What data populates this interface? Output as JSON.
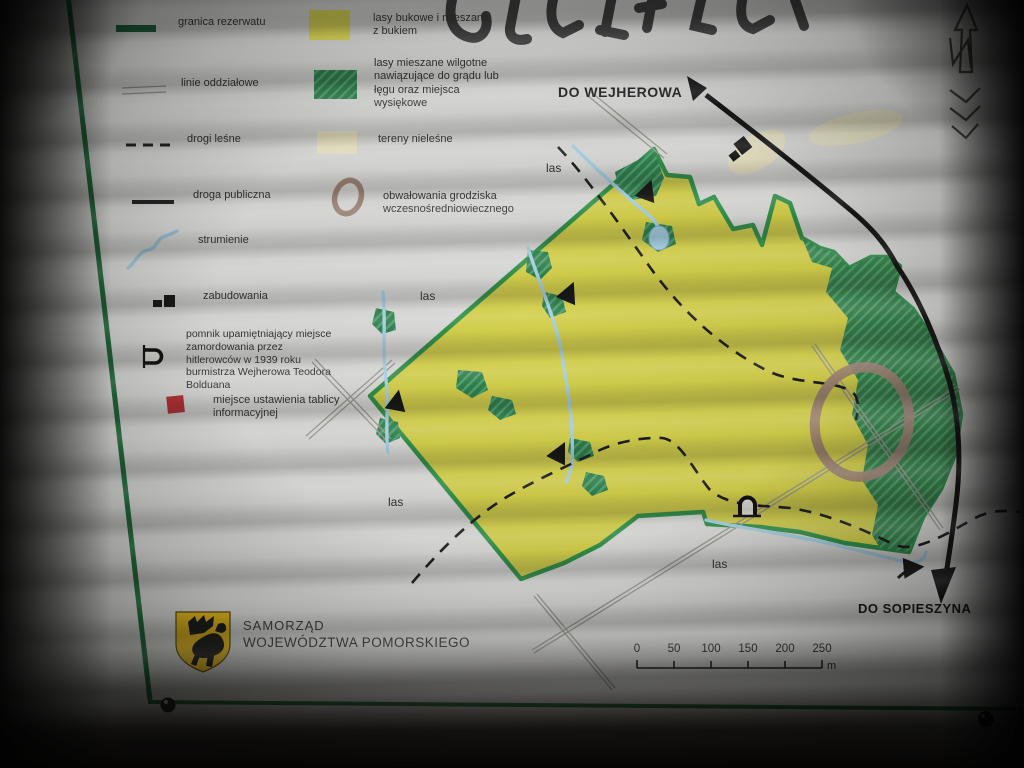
{
  "legend": {
    "items": [
      {
        "symbol": "reserve-boundary",
        "label": "granica rezerwatu"
      },
      {
        "symbol": "compartment-lines",
        "label": "linie oddziałowe"
      },
      {
        "symbol": "forest-roads",
        "label": "drogi leśne"
      },
      {
        "symbol": "public-road",
        "label": "droga publiczna"
      },
      {
        "symbol": "streams",
        "label": "strumienie"
      },
      {
        "symbol": "buildings",
        "label": "zabudowania"
      },
      {
        "symbol": "monument",
        "label": "pomnik upamiętniający miejsce zamordowania przez hitlerowców w 1939 roku burmistrza Wejherowa Teodora Bolduana"
      },
      {
        "symbol": "info-board",
        "label": "miejsce ustawienia tablicy informacyjnej"
      }
    ],
    "areas": [
      {
        "symbol": "beech-forest",
        "label": "lasy bukowe i mieszane z bukiem"
      },
      {
        "symbol": "wet-mixed-forest",
        "label": "lasy mieszane wilgotne nawiązujące do grądu lub łęgu oraz miejsca wysiękowe"
      },
      {
        "symbol": "non-forest",
        "label": "tereny nieleśne"
      },
      {
        "symbol": "rampart",
        "label": "obwałowania grodziska wczesnośredniowiecznego"
      }
    ]
  },
  "map": {
    "direction_labels": {
      "north_road": "DO WEJHEROWA",
      "south_road": "DO SOPIESZYNA"
    },
    "forest_labels": [
      "las",
      "las",
      "las",
      "las"
    ]
  },
  "scalebar": {
    "ticks": [
      "0",
      "50",
      "100",
      "150",
      "200",
      "250"
    ],
    "unit": "m"
  },
  "footer": {
    "org_line1": "SAMORZĄD",
    "org_line2": "WOJEWÓDZTWA POMORSKIEGO"
  },
  "colors": {
    "reserve_fill": "#d2ce49",
    "boundary_green": "#2e8f47",
    "wet_forest_green": "#2c7d4b",
    "non_forest_cream": "#e8e2c0",
    "rampart_brown": "#9d8173",
    "stream_blue": "#a4cfe2",
    "info_board_red": "#b82f35",
    "road_black": "#141414",
    "crest_gold": "#e5b91b"
  }
}
